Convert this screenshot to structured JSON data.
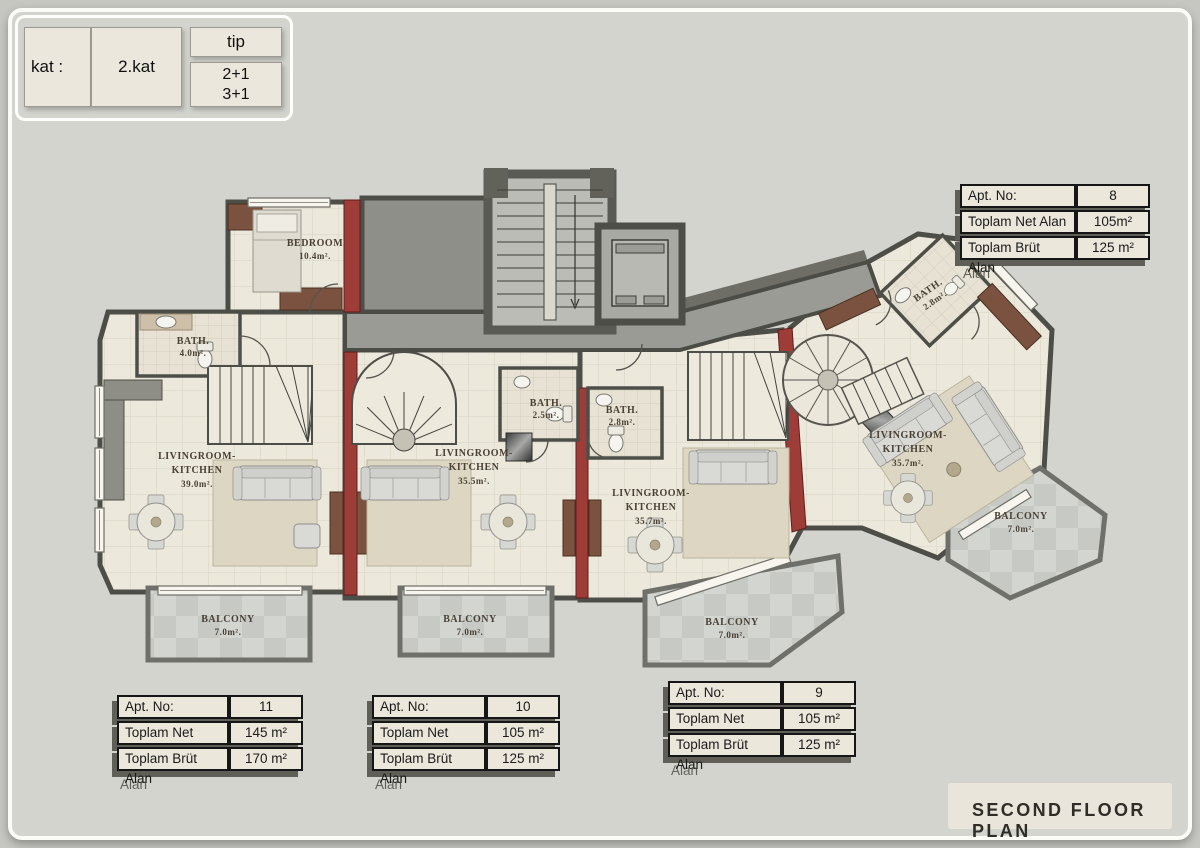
{
  "page": {
    "title": "SECOND FLOOR PLAN"
  },
  "legend": {
    "kat_label": "kat :",
    "kat_value": "2.kat",
    "tip_label": "tip",
    "tip_option1": "2+1",
    "tip_option2": "3+1"
  },
  "tables": {
    "labels": {
      "no": "Apt. No:",
      "net": "Toplam Net Alan",
      "brut": "Toplam Brüt Alan"
    },
    "apartments": [
      {
        "id": "apt-8",
        "no": "8",
        "net": "105m²",
        "brut": "125 m²"
      },
      {
        "id": "apt-11",
        "no": "11",
        "net": "145 m²",
        "brut": "170 m²"
      },
      {
        "id": "apt-10",
        "no": "10",
        "net": "105 m²",
        "brut": "125 m²"
      },
      {
        "id": "apt-9",
        "no": "9",
        "net": "105 m²",
        "brut": "125 m²"
      }
    ]
  },
  "rooms": {
    "bedroom": {
      "name": "BEDROOM",
      "area": "10.4m²."
    },
    "bath_11": {
      "name": "BATH.",
      "area": "4.0m²."
    },
    "living_11": {
      "name1": "LIVINGROOM-",
      "name2": "KITCHEN",
      "area": "39.0m²."
    },
    "living_10": {
      "name1": "LIVINGROOM-",
      "name2": "KITCHEN",
      "area": "35.5m²."
    },
    "bath_10": {
      "name": "BATH.",
      "area": "2.5m²."
    },
    "bath_9": {
      "name": "BATH.",
      "area": "2.8m²."
    },
    "living_9": {
      "name1": "LIVINGROOM-",
      "name2": "KITCHEN",
      "area": "35.7m²."
    },
    "bath_8": {
      "name": "BATH.",
      "area": "2.8m²."
    },
    "living_8": {
      "name1": "LIVINGROOM-",
      "name2": "KITCHEN",
      "area": "35.7m²."
    },
    "balcony_11": {
      "name": "BALCONY",
      "area": "7.0m²."
    },
    "balcony_10": {
      "name": "BALCONY",
      "area": "7.0m²."
    },
    "balcony_9": {
      "name": "BALCONY",
      "area": "7.0m²."
    },
    "balcony_8": {
      "name": "BALCONY",
      "area": "7.0m²."
    }
  },
  "colors": {
    "wall": "#4e4e48",
    "red_wall": "#9e3c38",
    "floor": "#ece8db",
    "balcony_tile": "#c9cbc7",
    "corridor": "#9b9b95",
    "background": "#d3d4ce"
  }
}
